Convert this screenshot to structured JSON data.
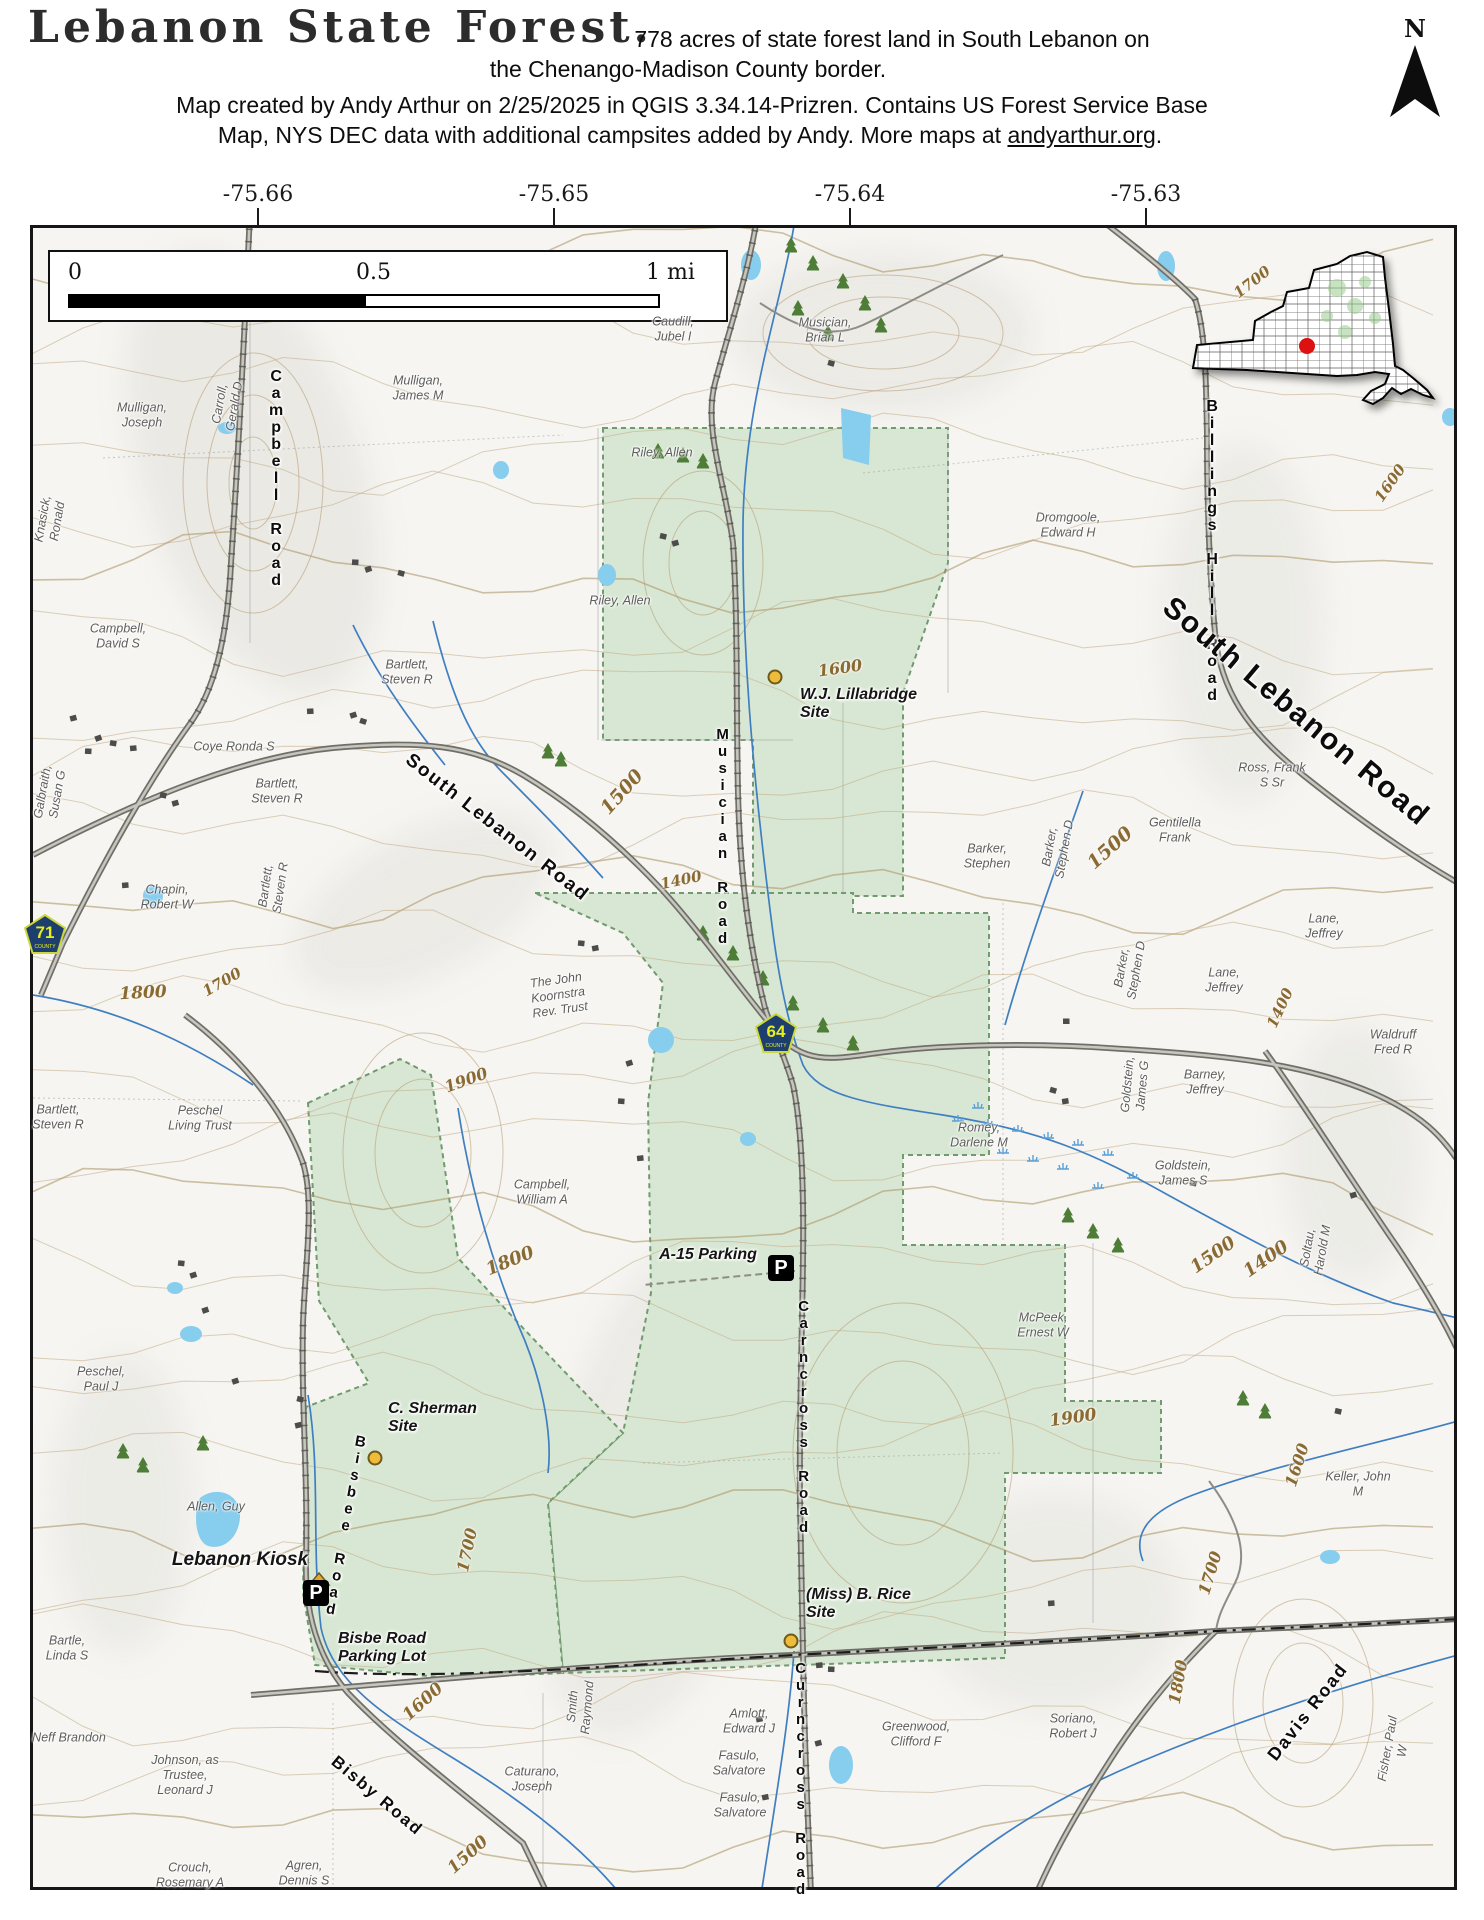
{
  "header": {
    "title": "Lebanon State Forest.",
    "subtitle_line1": "778 acres of state forest land in South Lebanon on",
    "subtitle_line2": "the Chenango-Madison County border.",
    "attribution_line1": "Map created by Andy Arthur on 2/25/2025 in QGIS 3.34.14-Prizren. Contains US Forest Service Base",
    "attribution_line2_prefix": "Map, NYS DEC data with additional campsites added by Andy. More maps at ",
    "attribution_link": "andyarthur.org",
    "attribution_line2_suffix": ".",
    "north_label": "N"
  },
  "scalebar": {
    "start": "0",
    "mid": "0.5",
    "end": "1 mi"
  },
  "longitude_ticks": [
    {
      "t": "-75.66",
      "x": 258
    },
    {
      "t": "-75.65",
      "x": 554
    },
    {
      "t": "-75.64",
      "x": 850
    },
    {
      "t": "-75.63",
      "x": 1146
    }
  ],
  "colors": {
    "forest_green": "#d8e7d3",
    "forest_border": "#6f9b6f",
    "pond_blue": "#86cdee",
    "stream_blue": "#3f7fc1",
    "contour_tan": "#c3ab87",
    "contour_label": "#8a6a33",
    "road_gray": "#8f8f88",
    "shield_navy": "#1e3f6e",
    "shield_yellow": "#e6ef1a",
    "campsite_yellow": "#eebc3a",
    "inset_dot_red": "#dd1111"
  },
  "map": {
    "parking_letter": "P",
    "shield_caption": "COUNTY",
    "route_shields": [
      {
        "n": "71",
        "x": 45,
        "y": 934
      },
      {
        "n": "64",
        "x": 776,
        "y": 1033
      }
    ],
    "campsites": [
      {
        "t": [
          "W.J. Lillabridge",
          "Site"
        ],
        "lx": 800,
        "ly": 686,
        "dx": 775,
        "dy": 677
      },
      {
        "t": [
          "C. Sherman",
          "Site"
        ],
        "lx": 388,
        "ly": 1400,
        "dx": 375,
        "dy": 1458
      },
      {
        "t": [
          "(Miss) B. Rice",
          "Site"
        ],
        "lx": 806,
        "ly": 1586,
        "dx": 791,
        "dy": 1641
      }
    ],
    "parking": [
      {
        "t": [
          "A-15 Parking"
        ],
        "lx": 708,
        "ly": 1246,
        "ix": 781,
        "iy": 1268
      },
      {
        "t": [
          "Bisbe Road",
          "Parking Lot"
        ],
        "lx": 382,
        "ly": 1630,
        "ix": 316,
        "iy": 1593
      }
    ],
    "poi_labels": [
      {
        "t": [
          "Lebanon Kiosk"
        ],
        "x": 240,
        "y": 1560,
        "size": 19
      }
    ],
    "road_labels": [
      {
        "t": "Campbell Road",
        "v": true,
        "x": 276,
        "y": 368,
        "s": 16
      },
      {
        "t": "Billings Hill Road",
        "v": true,
        "x": 1212,
        "y": 398,
        "s": 16
      },
      {
        "t": "Musician Road",
        "v": true,
        "x": 722,
        "y": 726,
        "s": 15
      },
      {
        "t": "Carncross Road",
        "v": true,
        "x": 803,
        "y": 1298,
        "s": 15
      },
      {
        "t": "Curncross Road",
        "v": true,
        "x": 800,
        "y": 1660,
        "s": 15
      },
      {
        "t": "Bisbee Road",
        "v": true,
        "x": 345,
        "y": 1432,
        "s": 15,
        "r": 10
      },
      {
        "t": "South Lebanon Road",
        "x": 497,
        "y": 828,
        "r": 38,
        "s": 19
      },
      {
        "t": "South Lebanon Road",
        "x": 1296,
        "y": 712,
        "r": 40,
        "s": 30
      },
      {
        "t": "Bisby Road",
        "x": 377,
        "y": 1796,
        "r": 40,
        "s": 17
      },
      {
        "t": "Davis Road",
        "x": 1308,
        "y": 1712,
        "r": -52,
        "s": 18
      }
    ],
    "contour_labels": [
      {
        "t": "1700",
        "x": 1252,
        "y": 282,
        "r": -38
      },
      {
        "t": "1600",
        "x": 1390,
        "y": 483,
        "r": -55
      },
      {
        "t": "1600",
        "x": 840,
        "y": 668,
        "r": -8,
        "s": 16
      },
      {
        "t": "1500",
        "x": 622,
        "y": 792,
        "r": -48,
        "s": 19
      },
      {
        "t": "1400",
        "x": 681,
        "y": 880,
        "r": -12,
        "s": 15
      },
      {
        "t": "1500",
        "x": 1110,
        "y": 848,
        "r": -42,
        "s": 19
      },
      {
        "t": "1400",
        "x": 1280,
        "y": 1008,
        "r": -65,
        "s": 15
      },
      {
        "t": "1800",
        "x": 143,
        "y": 993,
        "r": -3,
        "s": 17
      },
      {
        "t": "1700",
        "x": 222,
        "y": 982,
        "r": -30,
        "s": 15
      },
      {
        "t": "1800",
        "x": 510,
        "y": 1261,
        "r": -22,
        "s": 18
      },
      {
        "t": "1900",
        "x": 466,
        "y": 1080,
        "r": -20,
        "s": 16
      },
      {
        "t": "1900",
        "x": 1073,
        "y": 1418,
        "r": -8,
        "s": 17
      },
      {
        "t": "1500",
        "x": 1213,
        "y": 1255,
        "r": -35,
        "s": 18
      },
      {
        "t": "1400",
        "x": 1266,
        "y": 1259,
        "r": -35,
        "s": 18
      },
      {
        "t": "1600",
        "x": 1297,
        "y": 1465,
        "r": -72,
        "s": 16
      },
      {
        "t": "1700",
        "x": 1210,
        "y": 1573,
        "r": -73,
        "s": 16
      },
      {
        "t": "1800",
        "x": 1178,
        "y": 1682,
        "r": -80,
        "s": 16
      },
      {
        "t": "1700",
        "x": 467,
        "y": 1550,
        "r": -78,
        "s": 16
      },
      {
        "t": "1600",
        "x": 423,
        "y": 1702,
        "r": -42,
        "s": 17
      },
      {
        "t": "1500",
        "x": 468,
        "y": 1855,
        "r": -42,
        "s": 17
      }
    ],
    "owner_labels": [
      {
        "t": [
          "Mulligan,",
          "Joseph"
        ],
        "x": 142,
        "y": 415
      },
      {
        "t": [
          "Carroll,",
          "Gerald D"
        ],
        "x": 227,
        "y": 405,
        "r": -80
      },
      {
        "t": [
          "Knasick,",
          "Ronald"
        ],
        "x": 50,
        "y": 520,
        "r": -80
      },
      {
        "t": [
          "Mulligan,",
          "James M"
        ],
        "x": 418,
        "y": 388
      },
      {
        "t": [
          "Caudill,",
          "Jubel I"
        ],
        "x": 673,
        "y": 329
      },
      {
        "t": [
          "Musician,",
          "Brian L"
        ],
        "x": 825,
        "y": 330
      },
      {
        "t": [
          "Riley, Allen"
        ],
        "x": 662,
        "y": 453
      },
      {
        "t": [
          "Riley, Allen"
        ],
        "x": 620,
        "y": 601
      },
      {
        "t": [
          "Dromgoole,",
          "Edward H"
        ],
        "x": 1068,
        "y": 525
      },
      {
        "t": [
          "Campbell,",
          "David S"
        ],
        "x": 118,
        "y": 636
      },
      {
        "t": [
          "Bartlett,",
          "Steven R"
        ],
        "x": 407,
        "y": 672
      },
      {
        "t": [
          "Coye Ronda S"
        ],
        "x": 234,
        "y": 747
      },
      {
        "t": [
          "Bartlett,",
          "Steven R"
        ],
        "x": 277,
        "y": 791
      },
      {
        "t": [
          "Bartlett,",
          "Steven R"
        ],
        "x": 273,
        "y": 887,
        "r": -82
      },
      {
        "t": [
          "Galbraith,",
          "Susan G"
        ],
        "x": 50,
        "y": 793,
        "r": -80
      },
      {
        "t": [
          "Chapin,",
          "Robert W"
        ],
        "x": 167,
        "y": 897
      },
      {
        "t": [
          "Ross, Frank",
          "S Sr"
        ],
        "x": 1272,
        "y": 775
      },
      {
        "t": [
          "Gentilella",
          "Frank"
        ],
        "x": 1175,
        "y": 830
      },
      {
        "t": [
          "Barker,",
          "Stephen"
        ],
        "x": 987,
        "y": 856
      },
      {
        "t": [
          "Barker,",
          "Stephen D"
        ],
        "x": 1057,
        "y": 848,
        "r": -80
      },
      {
        "t": [
          "Barker,",
          "Stephen D"
        ],
        "x": 1129,
        "y": 969,
        "r": -80
      },
      {
        "t": [
          "Lane,",
          "Jeffrey"
        ],
        "x": 1324,
        "y": 926
      },
      {
        "t": [
          "Lane,",
          "Jeffrey"
        ],
        "x": 1224,
        "y": 980
      },
      {
        "t": [
          "Waldruff",
          "Fred R"
        ],
        "x": 1393,
        "y": 1042
      },
      {
        "t": [
          "Barney,",
          "Jeffrey"
        ],
        "x": 1205,
        "y": 1082
      },
      {
        "t": [
          "Goldstein,",
          "James G"
        ],
        "x": 1135,
        "y": 1085,
        "r": -85
      },
      {
        "t": [
          "The John",
          "Koornstra",
          "Rev. Trust"
        ],
        "x": 558,
        "y": 995,
        "r": -8
      },
      {
        "t": [
          "Romey,",
          "Darlene M"
        ],
        "x": 979,
        "y": 1135
      },
      {
        "t": [
          "Goldstein,",
          "James S"
        ],
        "x": 1183,
        "y": 1173
      },
      {
        "t": [
          "Soltau,",
          "Harold M"
        ],
        "x": 1315,
        "y": 1249,
        "r": -80
      },
      {
        "t": [
          "McPeek,",
          "Ernest W"
        ],
        "x": 1043,
        "y": 1325
      },
      {
        "t": [
          "Peschel",
          "Living Trust"
        ],
        "x": 200,
        "y": 1118
      },
      {
        "t": [
          "Bartlett,",
          "Steven R"
        ],
        "x": 58,
        "y": 1117
      },
      {
        "t": [
          "Campbell,",
          "William A"
        ],
        "x": 542,
        "y": 1192
      },
      {
        "t": [
          "Peschel,",
          "Paul J"
        ],
        "x": 101,
        "y": 1379
      },
      {
        "t": [
          "Allen, Guy"
        ],
        "x": 216,
        "y": 1507
      },
      {
        "t": [
          "Keller, John",
          "M"
        ],
        "x": 1358,
        "y": 1484
      },
      {
        "t": [
          "Bartle,",
          "Linda S"
        ],
        "x": 67,
        "y": 1648
      },
      {
        "t": [
          "Neff Brandon"
        ],
        "x": 69,
        "y": 1738
      },
      {
        "t": [
          "Johnson, as",
          "Trustee,",
          "Leonard J"
        ],
        "x": 185,
        "y": 1775
      },
      {
        "t": [
          "Crouch,",
          "Rosemary A"
        ],
        "x": 190,
        "y": 1875
      },
      {
        "t": [
          "Agren,",
          "Dennis S"
        ],
        "x": 304,
        "y": 1873
      },
      {
        "t": [
          "Smith",
          "Raymond"
        ],
        "x": 580,
        "y": 1707,
        "r": -85
      },
      {
        "t": [
          "Caturano,",
          "Joseph"
        ],
        "x": 532,
        "y": 1779
      },
      {
        "t": [
          "Amlott,",
          "Edward J"
        ],
        "x": 749,
        "y": 1721
      },
      {
        "t": [
          "Fasulo,",
          "Salvatore"
        ],
        "x": 739,
        "y": 1763
      },
      {
        "t": [
          "Fasulo,",
          "Salvatore"
        ],
        "x": 740,
        "y": 1805
      },
      {
        "t": [
          "Greenwood,",
          "Clifford F"
        ],
        "x": 916,
        "y": 1734
      },
      {
        "t": [
          "Soriano,",
          "Robert J"
        ],
        "x": 1073,
        "y": 1726
      },
      {
        "t": [
          "Fisher, Paul",
          "W"
        ],
        "x": 1395,
        "y": 1750,
        "r": -80
      }
    ]
  }
}
